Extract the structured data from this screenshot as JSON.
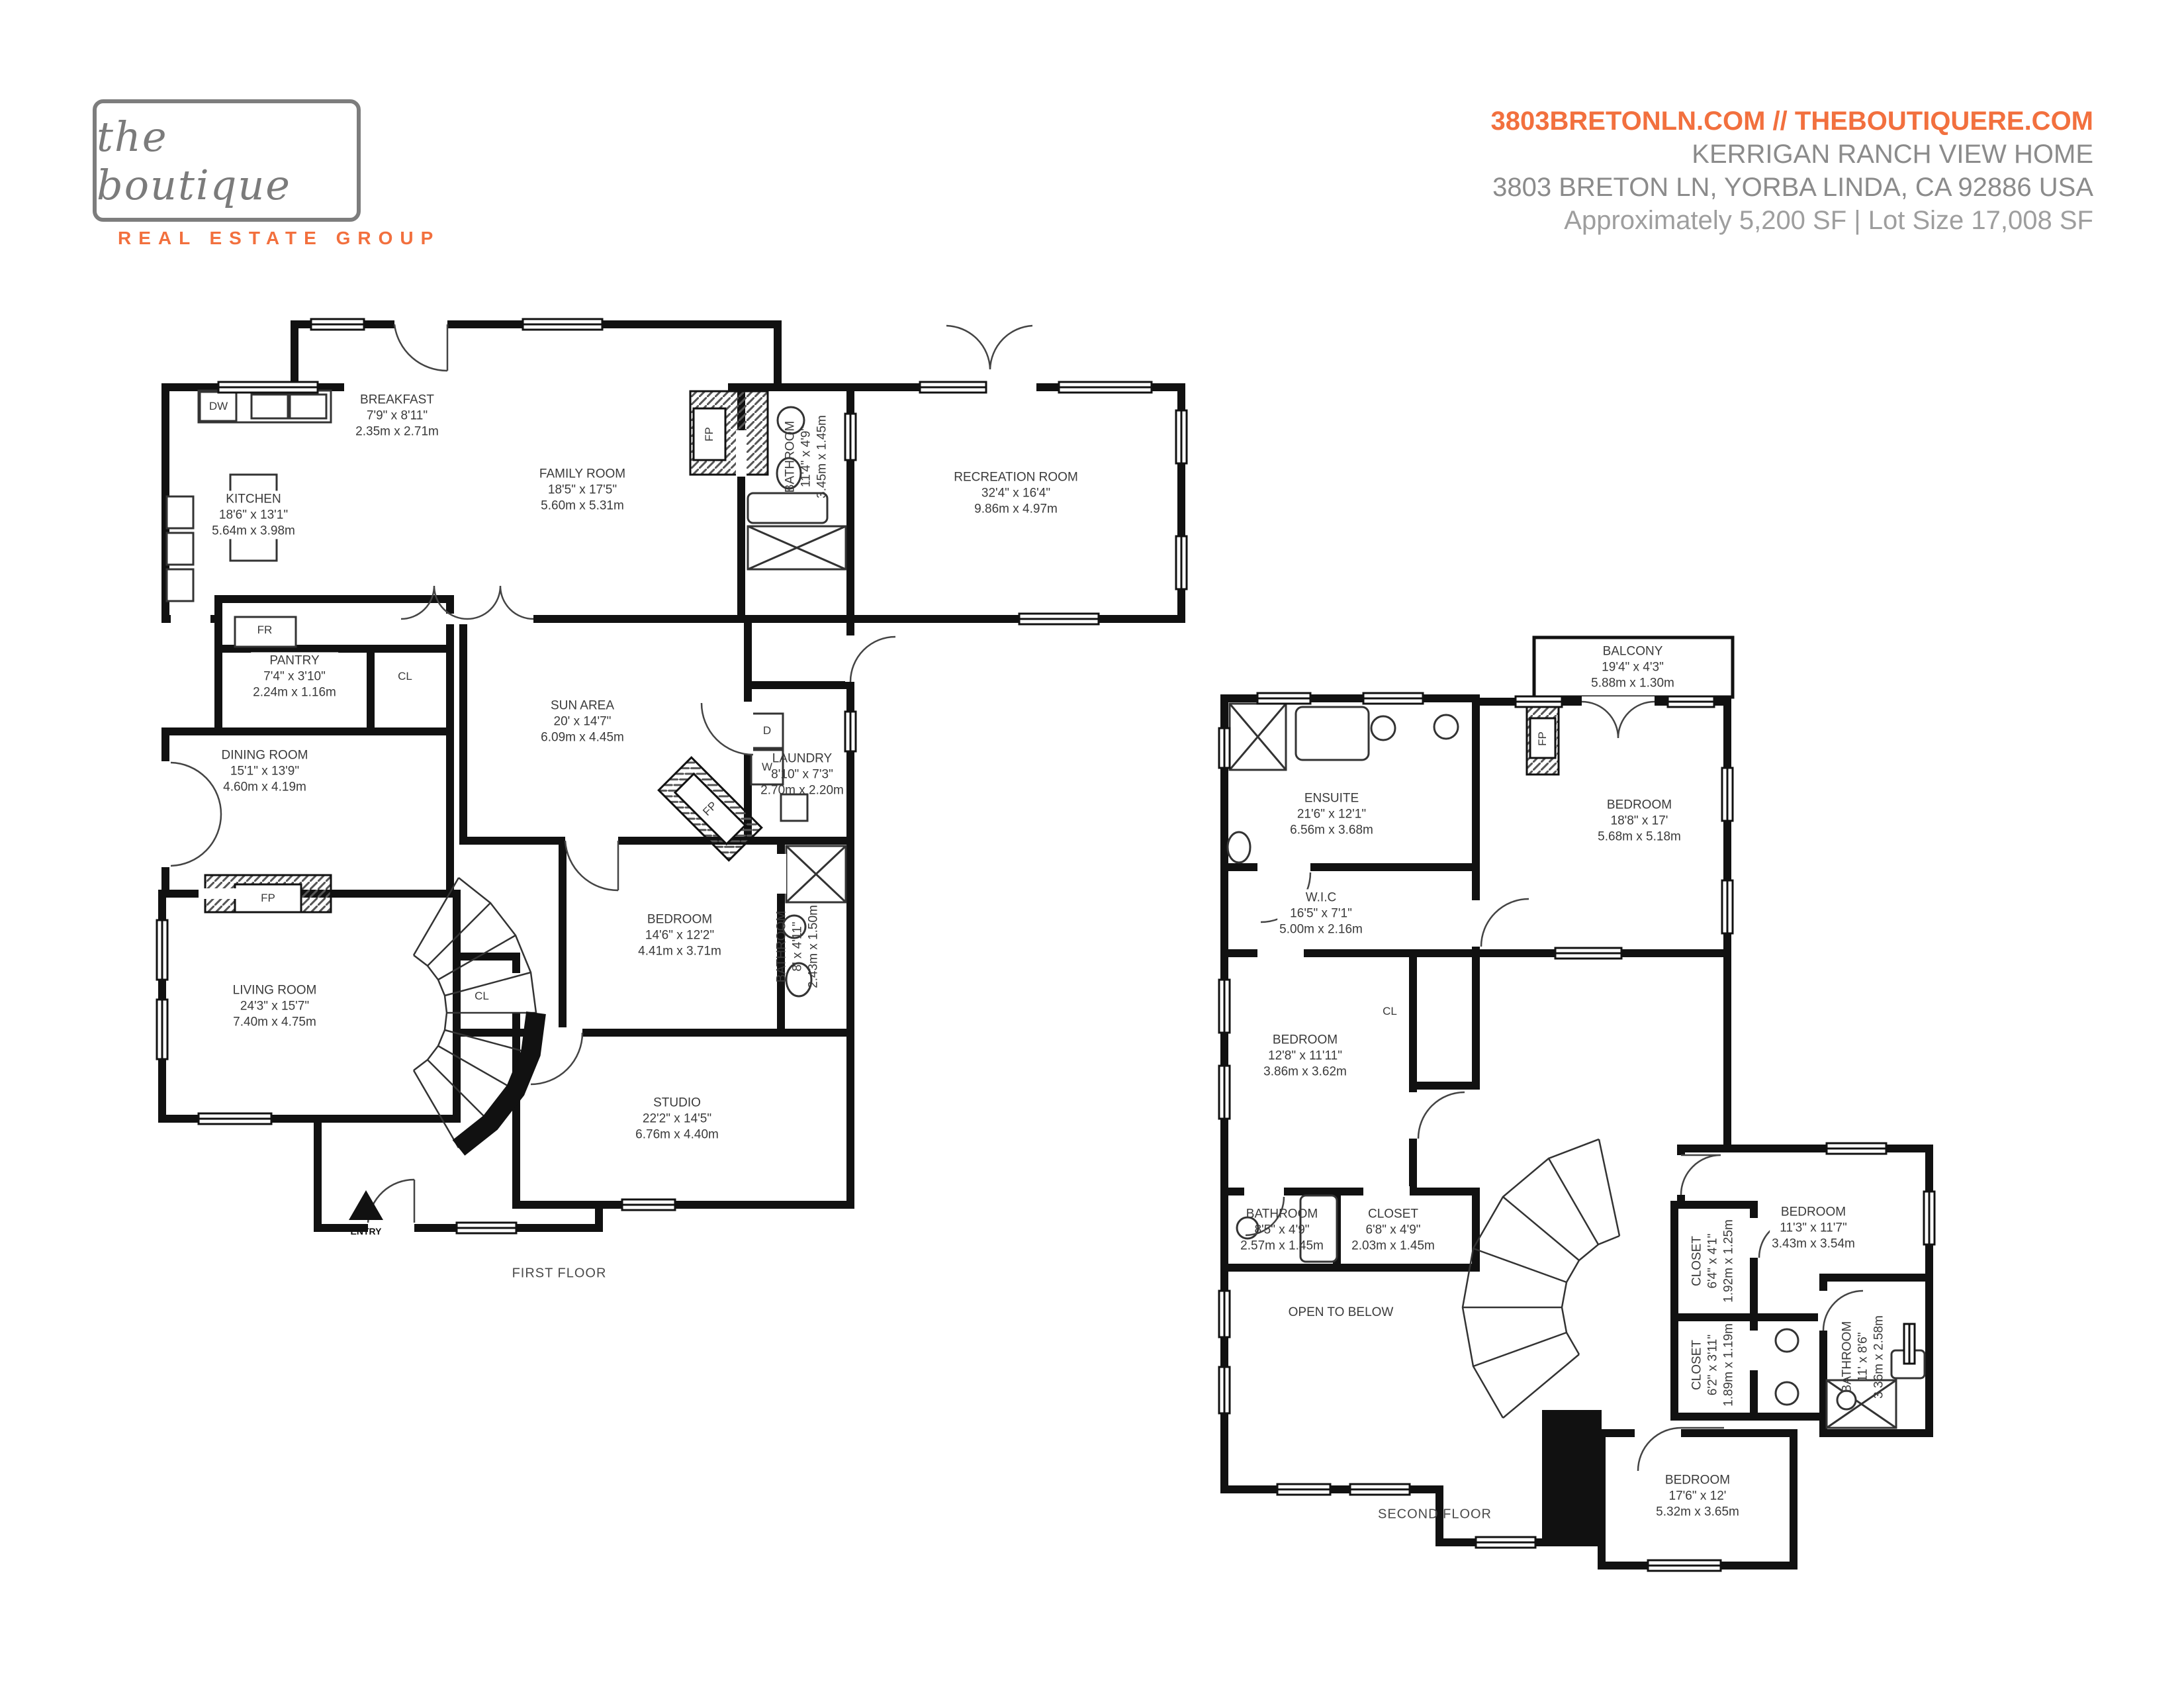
{
  "header": {
    "logo_name": "the boutique",
    "logo_tagline": "REAL ESTATE GROUP",
    "website_line": "3803BRETONLN.COM // THEBOUTIQUERE.COM",
    "title": "KERRIGAN RANCH VIEW HOME",
    "address": "3803 BRETON LN, YORBA LINDA, CA 92886 USA",
    "size_line": "Approximately 5,200 SF | Lot Size 17,008 SF"
  },
  "colors": {
    "accent_orange": "#F2703E",
    "header_gray": "#8B8B8B",
    "light_gray": "#9E9E9E",
    "logo_gray": "#7B7B7B",
    "wall_black": "#111111",
    "plan_text": "#3A3A3A"
  },
  "marks": {
    "dw": "DW",
    "fr": "FR",
    "cl": "CL",
    "d": "D",
    "w": "W",
    "fp": "FP"
  },
  "floor1": {
    "label": "FIRST FLOOR",
    "entry_label": "ENTRY",
    "rooms": {
      "breakfast": {
        "name": "BREAKFAST",
        "ft": "7'9\" x 8'11\"",
        "m": "2.35m x 2.71m"
      },
      "kitchen": {
        "name": "KITCHEN",
        "ft": "18'6\" x 13'1\"",
        "m": "5.64m x 3.98m"
      },
      "family": {
        "name": "FAMILY ROOM",
        "ft": "18'5\" x 17'5\"",
        "m": "5.60m x 5.31m"
      },
      "bathroom_top": {
        "name": "BATHROOM",
        "ft": "11'4\" x 4'9\"",
        "m": "3.45m x 1.45m"
      },
      "recreation": {
        "name": "RECREATION ROOM",
        "ft": "32'4\" x 16'4\"",
        "m": "9.86m x 4.97m"
      },
      "pantry": {
        "name": "PANTRY",
        "ft": "7'4\" x 3'10\"",
        "m": "2.24m x 1.16m"
      },
      "dining": {
        "name": "DINING ROOM",
        "ft": "15'1\" x 13'9\"",
        "m": "4.60m x 4.19m"
      },
      "sun": {
        "name": "SUN AREA",
        "ft": "20' x 14'7\"",
        "m": "6.09m x 4.45m"
      },
      "laundry": {
        "name": "LAUNDRY",
        "ft": "8'10\" x 7'3\"",
        "m": "2.70m x 2.20m"
      },
      "bathroom_mid": {
        "name": "BATHROOM",
        "ft": "8' x 4'11\"",
        "m": "2.43m x 1.50m"
      },
      "living": {
        "name": "LIVING ROOM",
        "ft": "24'3\" x 15'7\"",
        "m": "7.40m x 4.75m"
      },
      "bedroom": {
        "name": "BEDROOM",
        "ft": "14'6\" x 12'2\"",
        "m": "4.41m x 3.71m"
      },
      "studio": {
        "name": "STUDIO",
        "ft": "22'2\" x 14'5\"",
        "m": "6.76m x 4.40m"
      }
    }
  },
  "floor2": {
    "label": "SECOND FLOOR",
    "open_below": "OPEN TO BELOW",
    "rooms": {
      "balcony": {
        "name": "BALCONY",
        "ft": "19'4\" x 4'3\"",
        "m": "5.88m x 1.30m"
      },
      "ensuite": {
        "name": "ENSUITE",
        "ft": "21'6\" x 12'1\"",
        "m": "6.56m x 3.68m"
      },
      "bedroom_master": {
        "name": "BEDROOM",
        "ft": "18'8\" x 17'",
        "m": "5.68m x 5.18m"
      },
      "wic": {
        "name": "W.I.C",
        "ft": "16'5\" x 7'1\"",
        "m": "5.00m x 2.16m"
      },
      "bedroom_mid": {
        "name": "BEDROOM",
        "ft": "12'8\" x 11'11\"",
        "m": "3.86m x 3.62m"
      },
      "bathroom_85": {
        "name": "BATHROOM",
        "ft": "8'5\" x 4'9\"",
        "m": "2.57m x 1.45m"
      },
      "closet_68": {
        "name": "CLOSET",
        "ft": "6'8\" x 4'9\"",
        "m": "2.03m x 1.45m"
      },
      "bedroom_11": {
        "name": "BEDROOM",
        "ft": "11'3\" x 11'7\"",
        "m": "3.43m x 3.54m"
      },
      "closet_64": {
        "name": "CLOSET",
        "ft": "6'4\" x 4'1\"",
        "m": "1.92m x 1.25m"
      },
      "closet_62": {
        "name": "CLOSET",
        "ft": "6'2\" x 3'11\"",
        "m": "1.89m x 1.19m"
      },
      "bathroom_11": {
        "name": "BATHROOM",
        "ft": "11' x 8'6\"",
        "m": "3.36m x 2.58m"
      },
      "bedroom_17": {
        "name": "BEDROOM",
        "ft": "17'6\" x 12'",
        "m": "5.32m x 3.65m"
      }
    }
  }
}
